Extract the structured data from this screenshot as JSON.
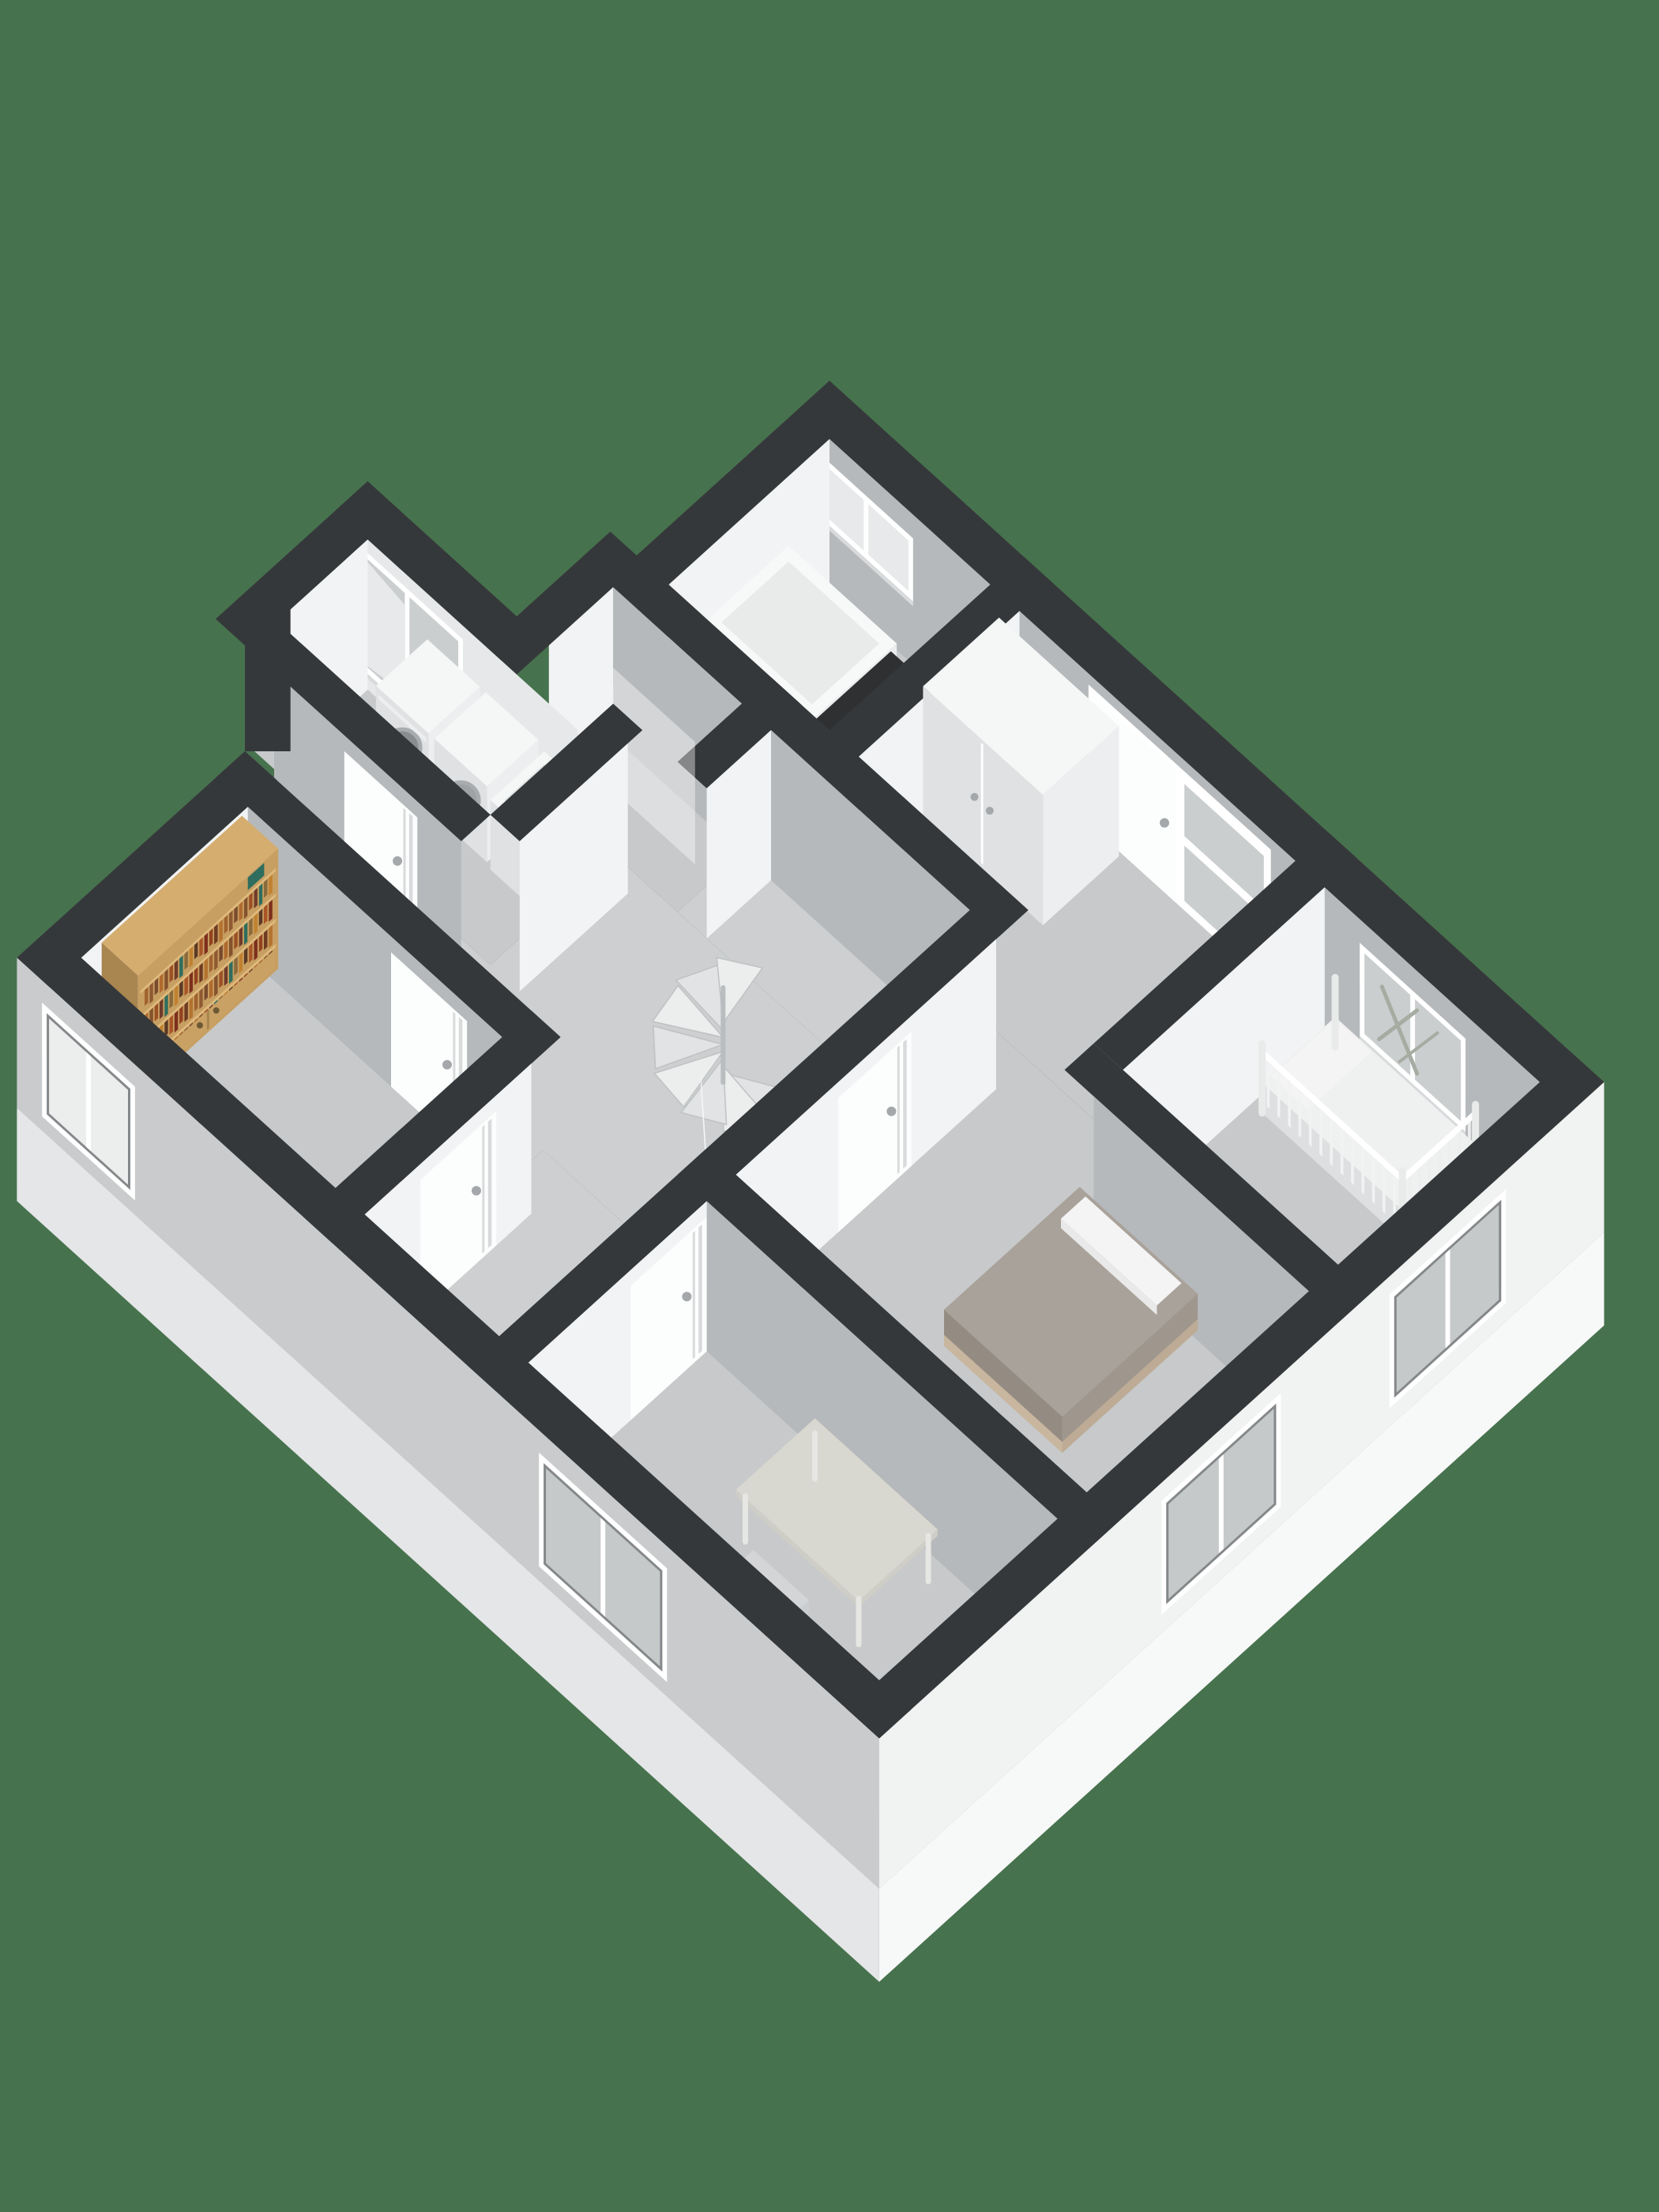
{
  "app": {
    "name": "3d-floorplan-render",
    "view": "upper-floor-isometric"
  },
  "palette": {
    "bg": "#47724E",
    "cap": "#35383A",
    "extWhite": "#F1F2F2",
    "extGray": "#C9CBCC",
    "intLight": "#F2F3F4",
    "intGray": "#B6B9BB",
    "dormerFace": "#E6E8E9",
    "floor": "#C7C9CA",
    "floorHall": "#CDCFD0",
    "slabSE": "#F7F8F8",
    "slabSW": "#E4E6E7",
    "frame": "#FFFFFF",
    "glass": "#CBCECF",
    "glassLight": "#E7E9EA",
    "glassExt": "#C6C9CA",
    "curtain": "#ECEDED",
    "reveal": "#85888A",
    "doorLeaf": "#FCFDFD",
    "doorSeam": "#D8DADC",
    "handle": "#A5A8AA",
    "tubWhite": "#F7F8F8",
    "tubSideU": "#ECEDEE",
    "tubSideV": "#E2E4E5",
    "basinInner": "#E9EBEB",
    "counterTop": "#2E3031",
    "counterSideU": "#262829",
    "counterSideV": "#3A3C3D",
    "chrome": "#B9BDBF",
    "chromeDark": "#8E9294",
    "boxTop": "#F5F6F6",
    "boxSideU": "#EDEEEF",
    "boxSideV": "#DFE1E2",
    "drumRing": "#A9ACAE",
    "drumMid": "#8A8D8F",
    "drumInner": "#606365",
    "duvetTop": "#A9A29A",
    "duvetSideU": "#9F978E",
    "duvetFront": "#948C83",
    "pillow": "#F4F4F4",
    "bedFrame": "#C9B69F",
    "oakTop": "#D4AD6F",
    "oakFront": "#C79F62",
    "oakSide": "#A9854F",
    "shelfBoard": "#DEB97C",
    "cabinetDoor": "#C9A164",
    "cabHandle": "#6E5834",
    "deskTop": "#D9D8D0",
    "deskEdge": "#CFCEC6",
    "deskLeg": "#E6E6E3",
    "chairSeat": "#D3D5D6",
    "chairBack": "#C7CACB",
    "mat": "#F0F0F0",
    "stairA": "#ECEDED",
    "stairB": "#E1E3E4",
    "stairEdge": "#BFC2C3",
    "plant": "#A7ACA2"
  },
  "books": [
    "#7A4A2E",
    "#8F5A33",
    "#A0622F",
    "#B4722F",
    "#6E3B22",
    "#93421F",
    "#7D2F1D",
    "#A85427",
    "#5D3A24",
    "#C1812F",
    "#8A6A3A",
    "#2F6D5E",
    "#703C2A",
    "#9C4F24",
    "#84522C",
    "#B06A2E"
  ],
  "rooms": [
    "bathroom",
    "landing",
    "nursery",
    "shower-room",
    "master-bedroom",
    "hallway",
    "laundry-room",
    "study",
    "south-bedroom"
  ],
  "objects": {
    "render": "floorplan-3d-render",
    "background": "backdrop",
    "slab": "floor-slab",
    "wallCap": "wall-cap",
    "wallFace": "wall-face",
    "floorName": "room-floor",
    "window": "window",
    "door": "interior-door",
    "frosted": "frosted-glass-panel",
    "bathtub": "bathtub",
    "counter": "bath-counter",
    "shower": "shower-set",
    "showerGlass": "shower-glass",
    "wardrobe": "wardrobe",
    "crib": "crib",
    "washer": "washing-machine",
    "dryer": "tumble-dryer",
    "laundryTub": "laundry-tub",
    "bed": "double-bed",
    "pillow": "pillow",
    "desk": "desk",
    "chair": "office-chair",
    "mat": "floor-mat",
    "bookshelf": "bookshelf",
    "stairs": "spiral-staircase",
    "railing": "stair-railing",
    "plant": "window-plant"
  }
}
